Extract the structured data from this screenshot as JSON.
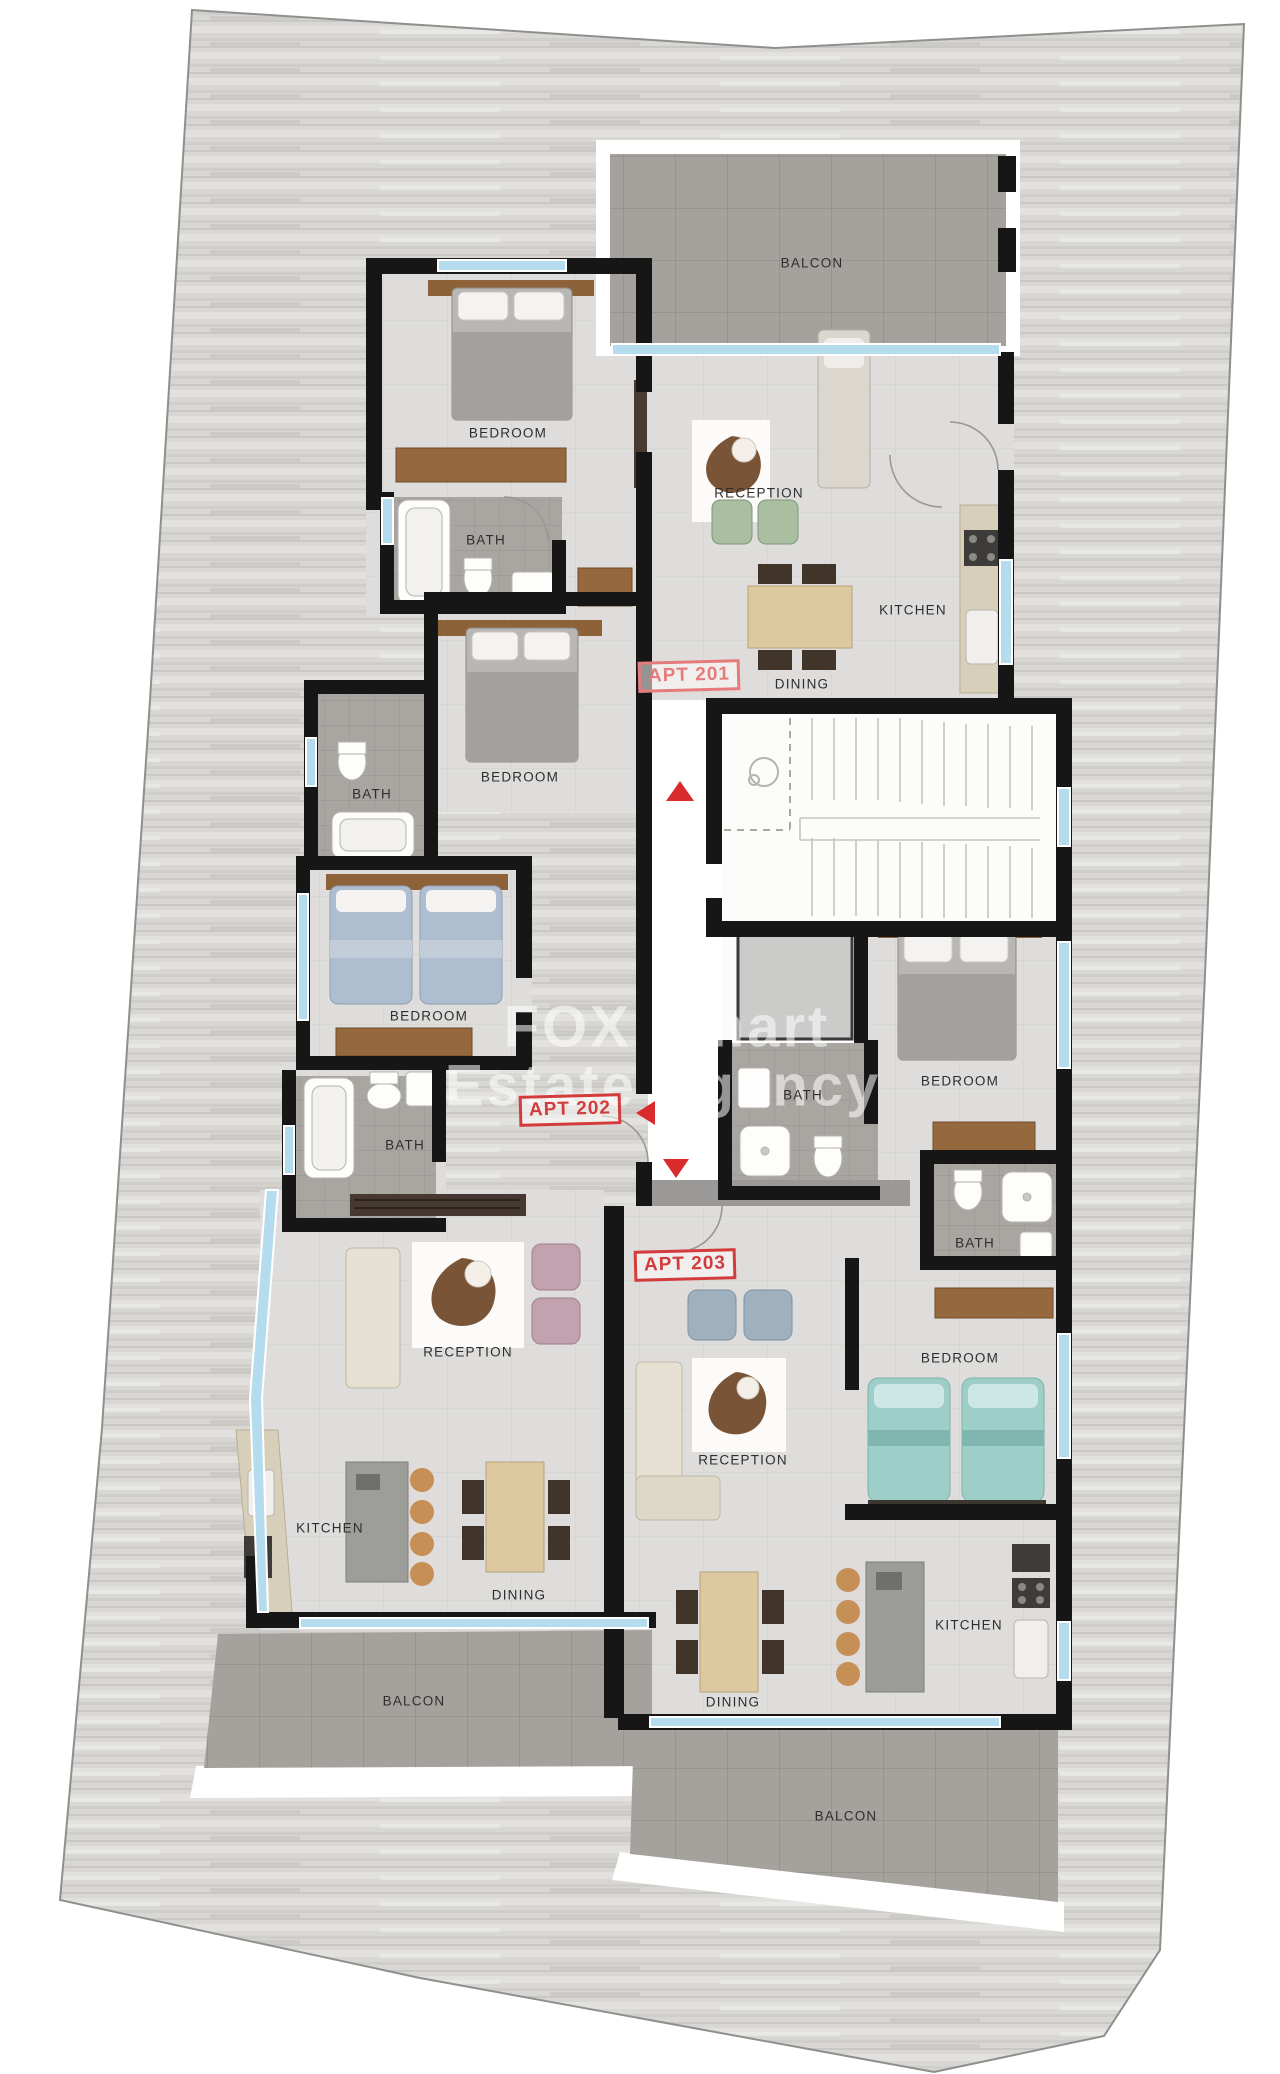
{
  "plan_type": "apartment-building-floor-plan",
  "watermark": {
    "line1": "FOX Smart",
    "line2": "Estate Agency"
  },
  "stamps": {
    "apt201": "APT 201",
    "apt202": "APT 202",
    "apt203": "APT 203"
  },
  "labels": {
    "apt201": {
      "balcon": "BALCON",
      "bedroom": "BEDROOM",
      "bath": "BATH",
      "reception": "RECEPTION",
      "kitchen": "KITCHEN",
      "dining": "DINING"
    },
    "apt202": {
      "bedroom1": "BEDROOM",
      "bath1": "BATH",
      "bedroom2": "BEDROOM",
      "bath2": "BATH",
      "reception": "RECEPTION",
      "kitchen": "KITCHEN",
      "dining": "DINING",
      "balcon": "BALCON"
    },
    "apt203": {
      "bath1": "BATH",
      "bedroom1": "BEDROOM",
      "bath2": "BATH",
      "bedroom2": "BEDROOM",
      "reception": "RECEPTION",
      "kitchen": "KITCHEN",
      "dining": "DINING",
      "balcon": "BALCON"
    }
  },
  "colors": {
    "wall": "#161616",
    "window_glass": "#b5dcee",
    "stamp_red_soft": "#e57b7b",
    "stamp_red": "#d23c3c",
    "arrow_red": "#d92b2b",
    "plot_wood": "#d8d7d4",
    "balcony_tile": "#a5a29d",
    "bath_tile": "#a9a6a2",
    "floor": "#dedddb",
    "wood_furniture": "#8d6238"
  }
}
